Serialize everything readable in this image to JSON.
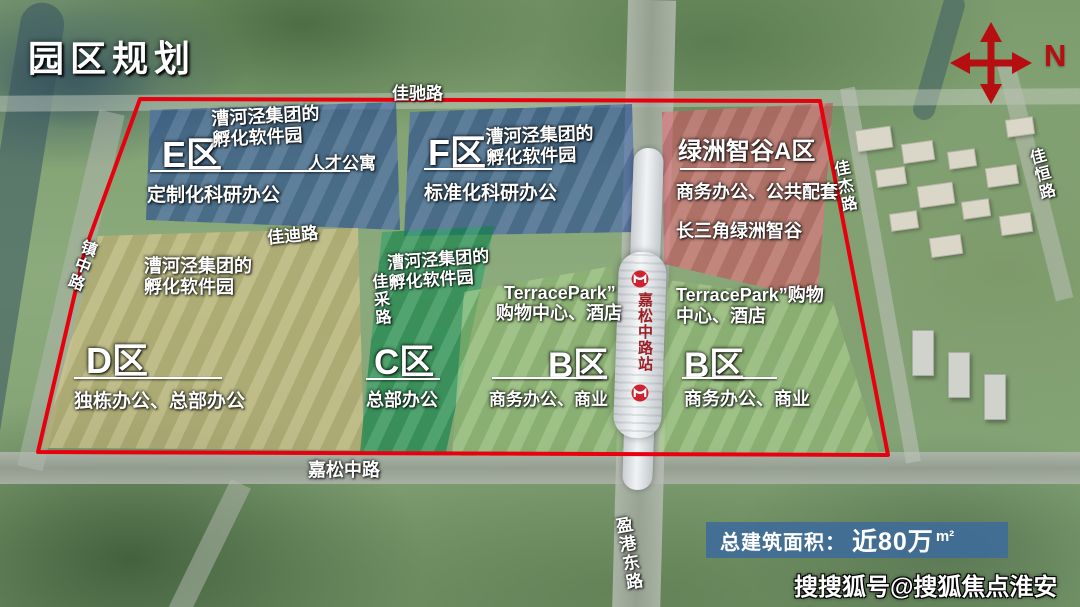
{
  "title": "园区规划",
  "compass": {
    "label": "N"
  },
  "zones": {
    "e": {
      "name": "E区",
      "org1": "漕河泾集团的",
      "org2": "孵化软件园",
      "tag": "人才公寓",
      "desc": "定制化科研办公"
    },
    "f": {
      "name": "F区",
      "org1": "漕河泾集团的",
      "org2": "孵化软件园",
      "desc": "标准化科研办公"
    },
    "a": {
      "name": "绿洲智谷A区",
      "desc": "商务办公、公共配套",
      "tag": "长三角绿洲智谷"
    },
    "d": {
      "name": "D区",
      "org1": "漕河泾集团的",
      "org2": "孵化软件园",
      "desc": "独栋办公、总部办公"
    },
    "c": {
      "name": "C区",
      "org1": "漕河泾集团的",
      "org2": "孵化软件园",
      "desc": "总部办公"
    },
    "b1": {
      "name": "B区",
      "retail1": "TerracePark”",
      "retail2": "购物中心、酒店",
      "desc": "商务办公、商业"
    },
    "b2": {
      "name": "B区",
      "retail1": "TerracePark”购物",
      "retail2": "中心、酒店",
      "desc": "商务办公、商业"
    }
  },
  "roads": {
    "jiachi": "佳驰路",
    "jiadi": "佳迪路",
    "jiacai": "佳采路",
    "zhenzhong": "镇中路",
    "jiasong": "嘉松中路",
    "yinggang": "盈港东路",
    "jiajie": "佳杰路",
    "jiaheng": "佳恒路"
  },
  "station": {
    "name": "嘉松中路站"
  },
  "stats": {
    "label": "总建筑面积：",
    "value": "近80万",
    "unit": "m²"
  },
  "watermark": "搜搜狐号@搜狐焦点淮安站",
  "colors": {
    "boundary": "#e8000f",
    "zone_blue": "#2e5fae",
    "zone_pink": "#d55f68",
    "zone_tan": "#cdbc7d",
    "zone_green": "#129052",
    "zone_light_green": "#9cc87d",
    "banner_bg": "#3e6b9b",
    "compass_red": "#b60f12",
    "station_text_red": "#9b1f24"
  }
}
